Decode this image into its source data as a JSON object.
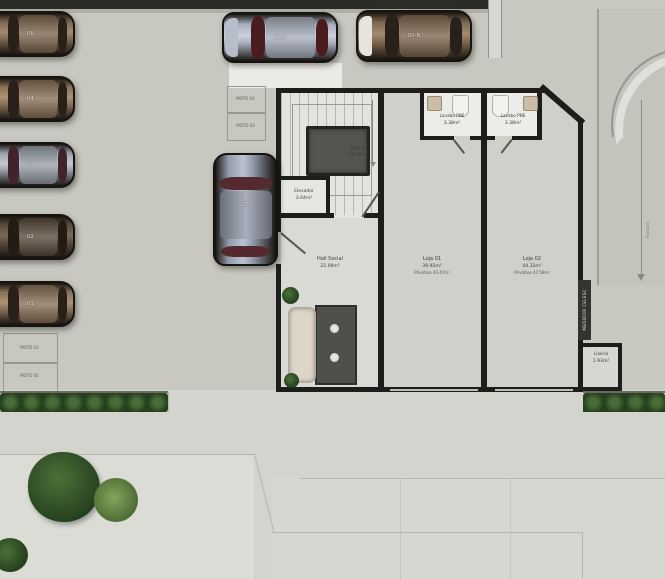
{
  "palette": {
    "garage_floor": "#c8c8c0",
    "interior_floor": "#dcdcd8",
    "loja_floor": "#d0d0ca",
    "sidewalk": "#d4d4ce",
    "wall": "#1d1d1b",
    "vegetation_green": "#35522b",
    "car_glass_red": "#4a1c20"
  },
  "rooms": {
    "escada": {
      "name": "Escada",
      "area": "14.10m²"
    },
    "elevador": {
      "name": "Elevador",
      "area": "3.64m²"
    },
    "hall_social": {
      "name": "Hall Social",
      "area": "22.09m²"
    },
    "lavabo_pne_1": {
      "name": "Lavabo PNE",
      "area": "3.38m²"
    },
    "lavabo_pne_2": {
      "name": "Lavabo PNE",
      "area": "3.38m²"
    },
    "loja_01": {
      "name": "Loja 01",
      "area": "39.92m²",
      "privativa": "Privativa 43.47m²"
    },
    "loja_02": {
      "name": "Loja 02",
      "area": "44.32m²",
      "privativa": "Privativa 47.56m²"
    },
    "medidor_celesc": {
      "name": "MEDIDOR CELESC"
    },
    "lixeira": {
      "name": "Lixeira",
      "area": "1.93m²"
    },
    "rampa": {
      "name": "Rampa"
    }
  },
  "parking": {
    "cars_left": [
      "06",
      "04",
      "03",
      "02",
      "01"
    ],
    "cars_top": [
      "05-A",
      "05-B"
    ],
    "car_center": "07",
    "motos_left": [
      "MOTO 02",
      "MOTO 01"
    ],
    "motos_center": [
      "MOTO 04",
      "MOTO 03"
    ]
  }
}
